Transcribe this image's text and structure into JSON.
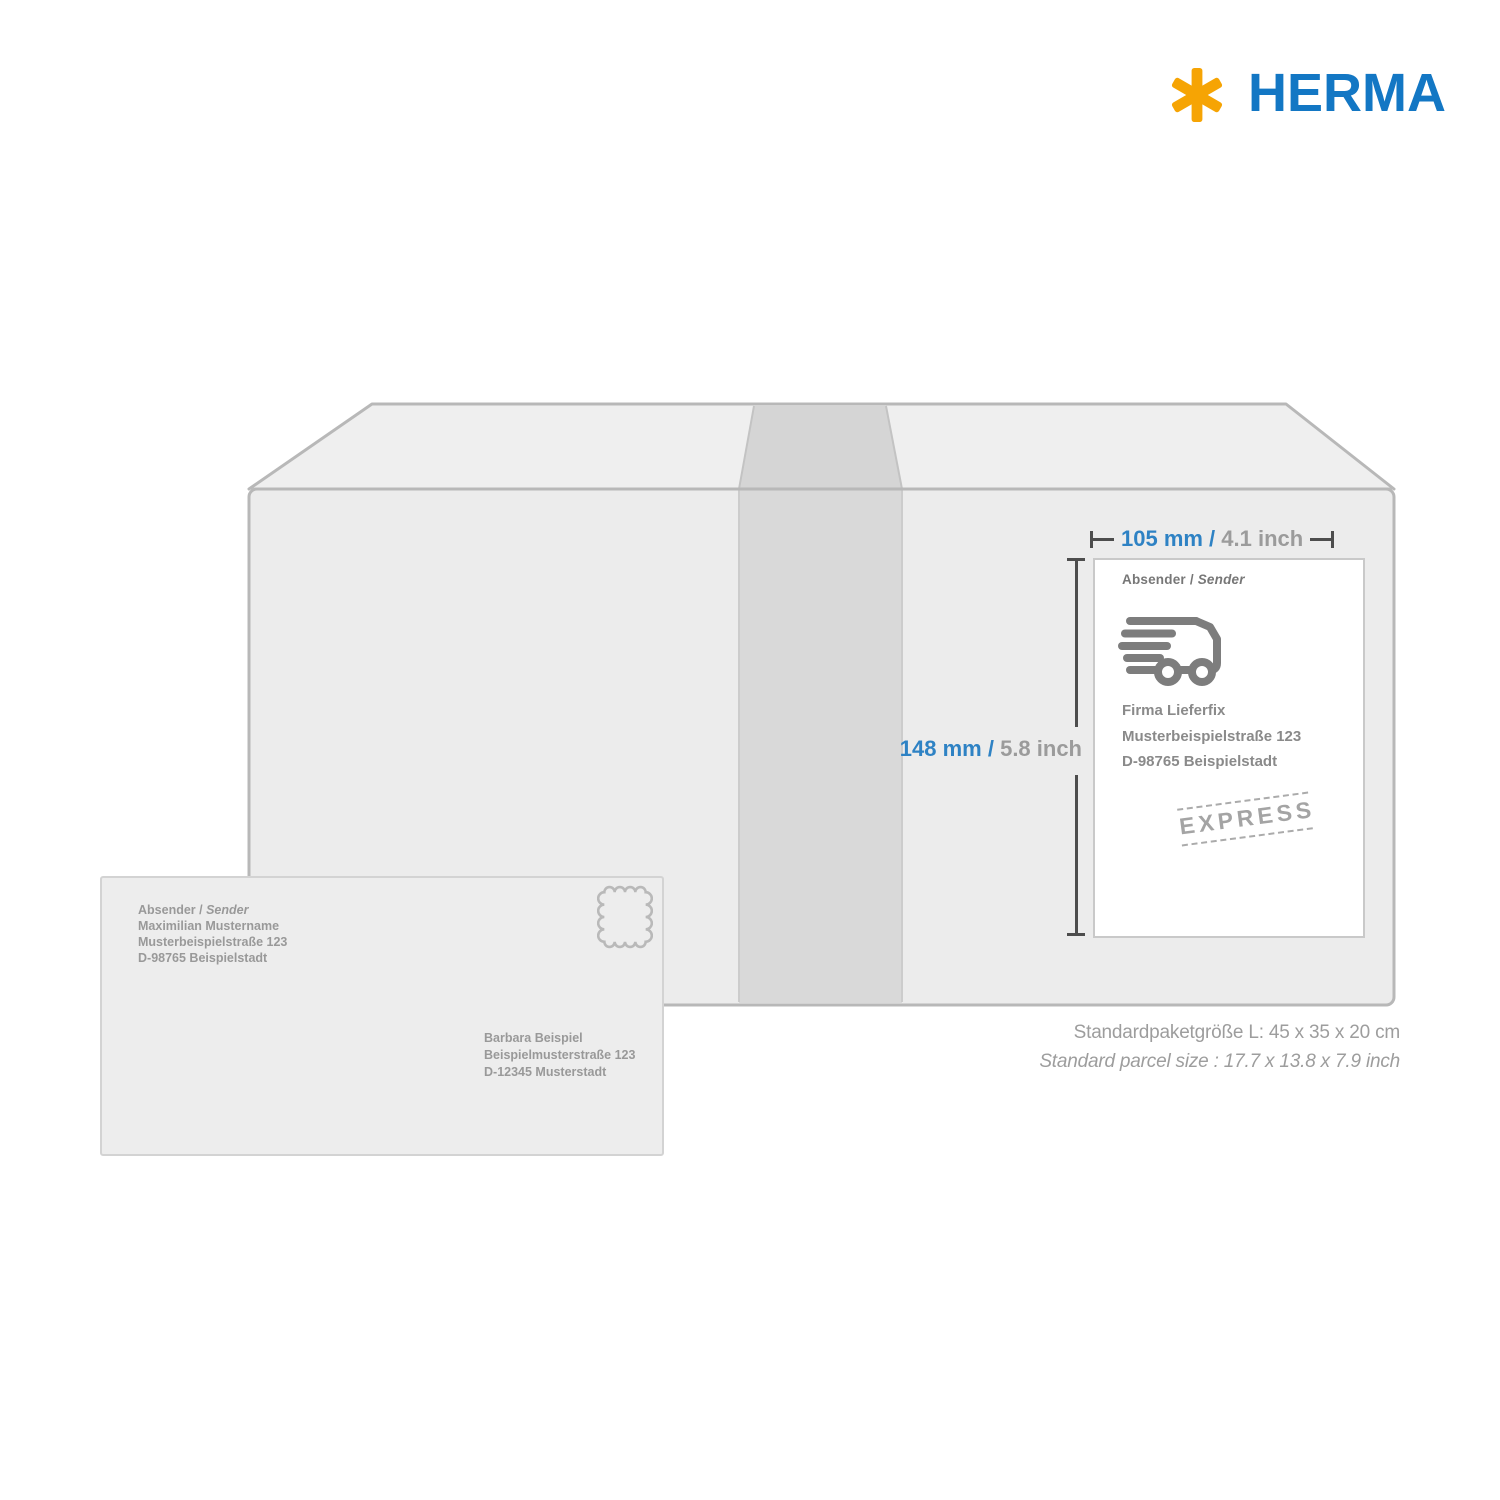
{
  "brand": {
    "name": "HERMA"
  },
  "dimensions": {
    "width_mm": "105 mm / ",
    "width_inch": "4.1 inch",
    "height_mm": "148 mm / ",
    "height_inch": "5.8 inch"
  },
  "shipping_label": {
    "header": "Absender / ",
    "header_italic": "Sender",
    "address": [
      "Firma Lieferfix",
      "Musterbeispielstraße 123",
      "D-98765 Beispielstadt"
    ],
    "stamp_text": "EXPRESS"
  },
  "envelope": {
    "header": "Absender / ",
    "header_italic": "Sender",
    "sender_lines": [
      "Maximilian Mustername",
      "Musterbeispielstraße 123",
      "D-98765 Beispielstadt"
    ],
    "recipient_lines": [
      "Barbara Beispiel",
      "Beispielmusterstraße 123",
      "D-12345 Musterstadt"
    ]
  },
  "caption": {
    "line_de": "Standardpaketgröße L: 45 x 35 x 20 cm",
    "line_en": "Standard parcel size : 17.7 x 13.8 x 7.9 inch"
  },
  "colors": {
    "brand_blue": "#1377c4",
    "brand_yellow": "#f6a404",
    "dimension_blue": "#2e82c4",
    "dimension_gray": "#9b9b9b",
    "box_face": "#ececec",
    "box_top_face": "#efefef",
    "tape": "#d9d9d9",
    "outline_gray": "#b8b8b8"
  }
}
